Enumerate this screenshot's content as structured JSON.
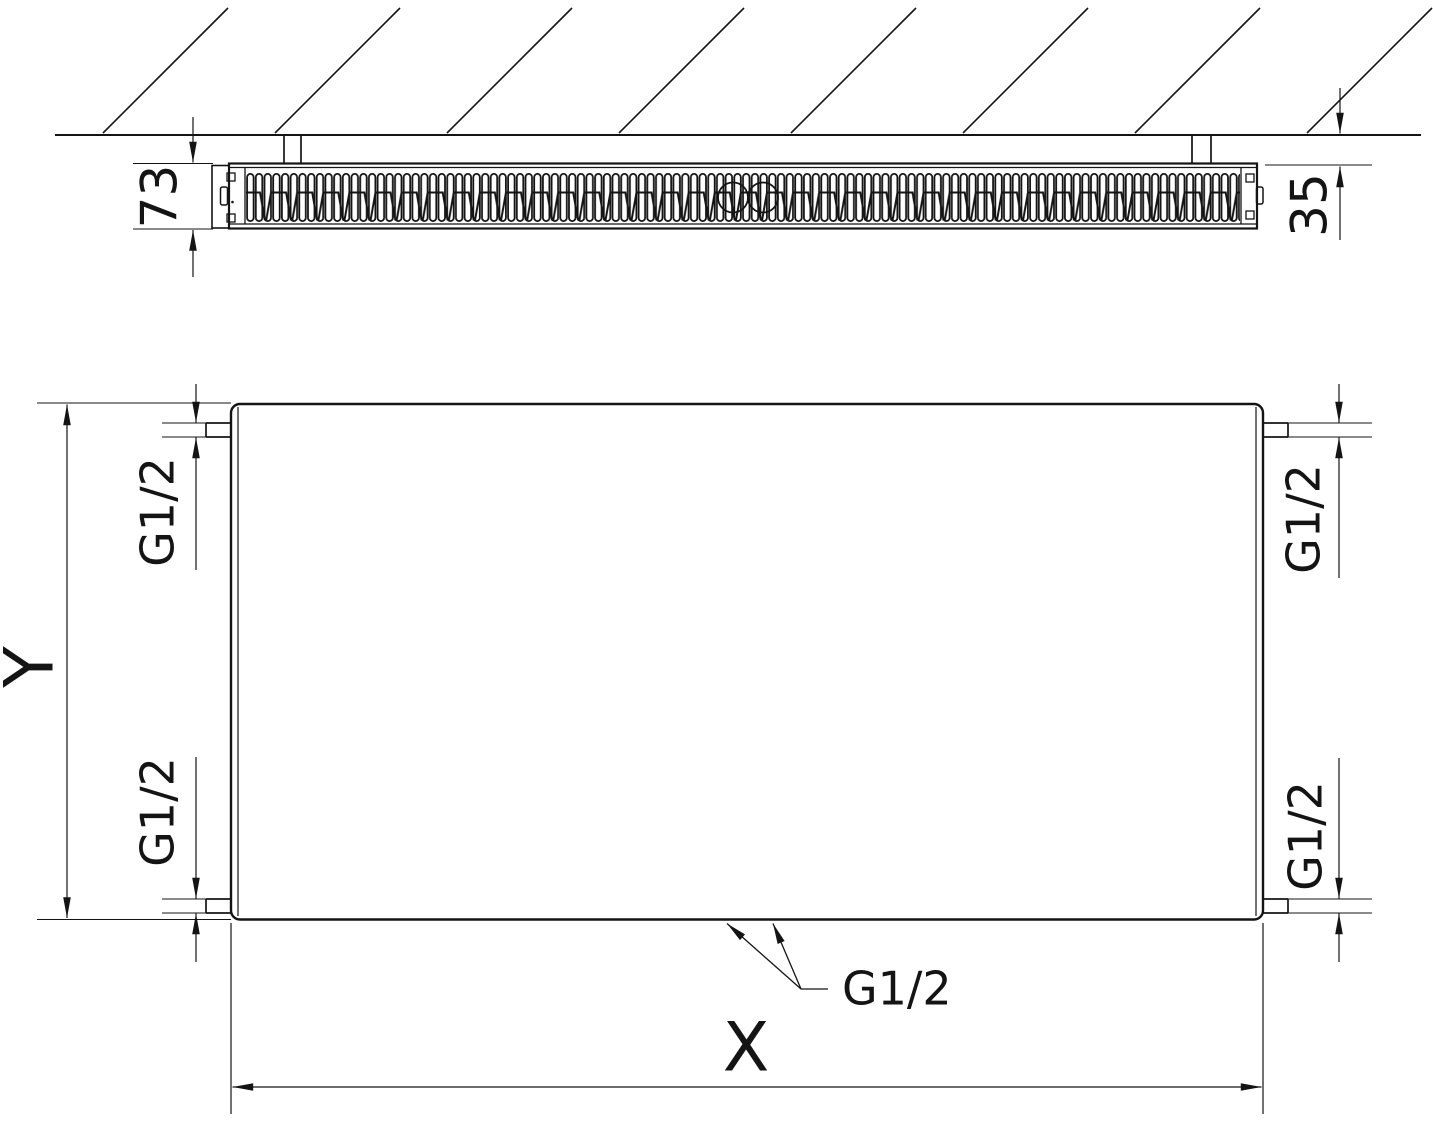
{
  "drawing": {
    "background": "#ffffff",
    "line_color": "#141414",
    "top_view": {
      "depth_dim": "73",
      "wall_gap_dim": "35"
    },
    "front_view": {
      "width_dim": "X",
      "height_dim": "Y",
      "connections": {
        "top_left": "G1/2",
        "top_right": "G1/2",
        "bottom_left": "G1/2",
        "bottom_right": "G1/2",
        "bottom_center": "G1/2"
      }
    }
  }
}
